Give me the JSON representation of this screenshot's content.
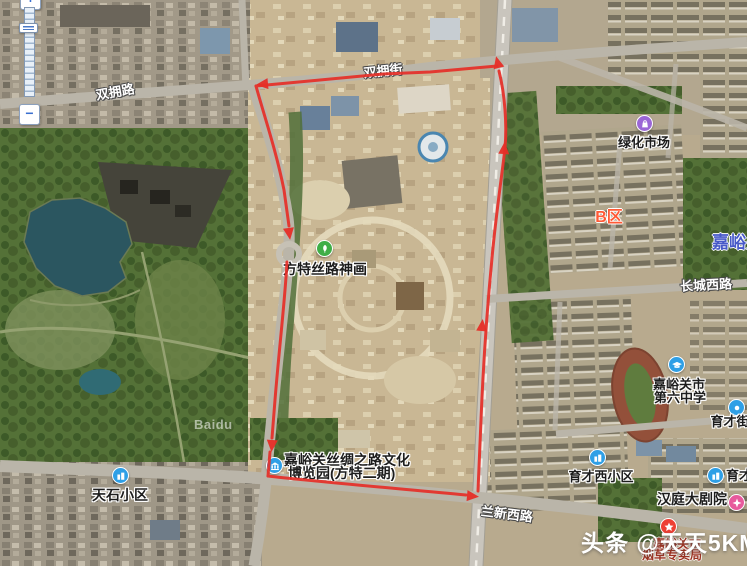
{
  "app": "satellite-map-viewer",
  "zoom_control": {
    "zoom_in_label": "+",
    "zoom_out_label": "−"
  },
  "watermarks": {
    "brand": "Baidu",
    "overlay": "头条 @天天5KM"
  },
  "road_labels": [
    {
      "id": "shuangyong-road",
      "text": "双拥路"
    },
    {
      "id": "shuangyong-street",
      "text": "双拥街"
    },
    {
      "id": "changcheng-west-road",
      "text": "长城西路"
    },
    {
      "id": "lanxin-west-road",
      "text": "兰新西路"
    }
  ],
  "area_labels": [
    {
      "id": "b-district",
      "text": "B区",
      "color": "#ff5a36"
    },
    {
      "id": "jiayuguan-city",
      "text": "嘉峪关",
      "color": "#4759c8"
    }
  ],
  "pois": [
    {
      "id": "fangte-silk-road",
      "lines": [
        "方特丝路神画"
      ],
      "icon": "scenic-icon",
      "icon_color": "#3fae47"
    },
    {
      "id": "lvhua-market",
      "lines": [
        "绿化市场"
      ],
      "icon": "shopping-icon",
      "icon_color": "#9b66d6"
    },
    {
      "id": "no6-middle-school",
      "lines": [
        "嘉峪关市",
        "第六中学"
      ],
      "icon": "school-icon",
      "icon_color": "#2e9fe6"
    },
    {
      "id": "yucai-street",
      "lines": [
        "育才街"
      ],
      "icon": "poi-icon",
      "icon_color": "#2e9fe6"
    },
    {
      "id": "yucai-west-community",
      "lines": [
        "育才西小区"
      ],
      "icon": "residence-icon",
      "icon_color": "#2e9fe6"
    },
    {
      "id": "yucai-clipped",
      "lines": [
        "育才"
      ],
      "icon": "residence-icon",
      "icon_color": "#2e9fe6"
    },
    {
      "id": "hanting-grand-theatre",
      "lines": [
        "汉庭大剧院"
      ],
      "icon": "theatre-icon",
      "icon_color": "#e75a9c"
    },
    {
      "id": "tianshi-community",
      "lines": [
        "天石小区"
      ],
      "icon": "residence-icon",
      "icon_color": "#2e9fe6"
    },
    {
      "id": "silk-road-expo-park",
      "lines": [
        "嘉峪关丝绸之路文化",
        "博览园(方特二期)"
      ],
      "icon": "museum-icon",
      "icon_color": "#2e9fe6"
    },
    {
      "id": "tobacco-bureau",
      "lines": [
        "嘉峪关市",
        "烟草专卖局"
      ],
      "icon": "star-icon",
      "icon_color": "#ee4035",
      "text_color": "#9c3322"
    }
  ],
  "route": {
    "color": "#e62f28",
    "shape": "closed loop around Fangte park and railway",
    "direction_arrows": [
      "west",
      "south",
      "south",
      "east",
      "north",
      "north",
      "north"
    ]
  }
}
